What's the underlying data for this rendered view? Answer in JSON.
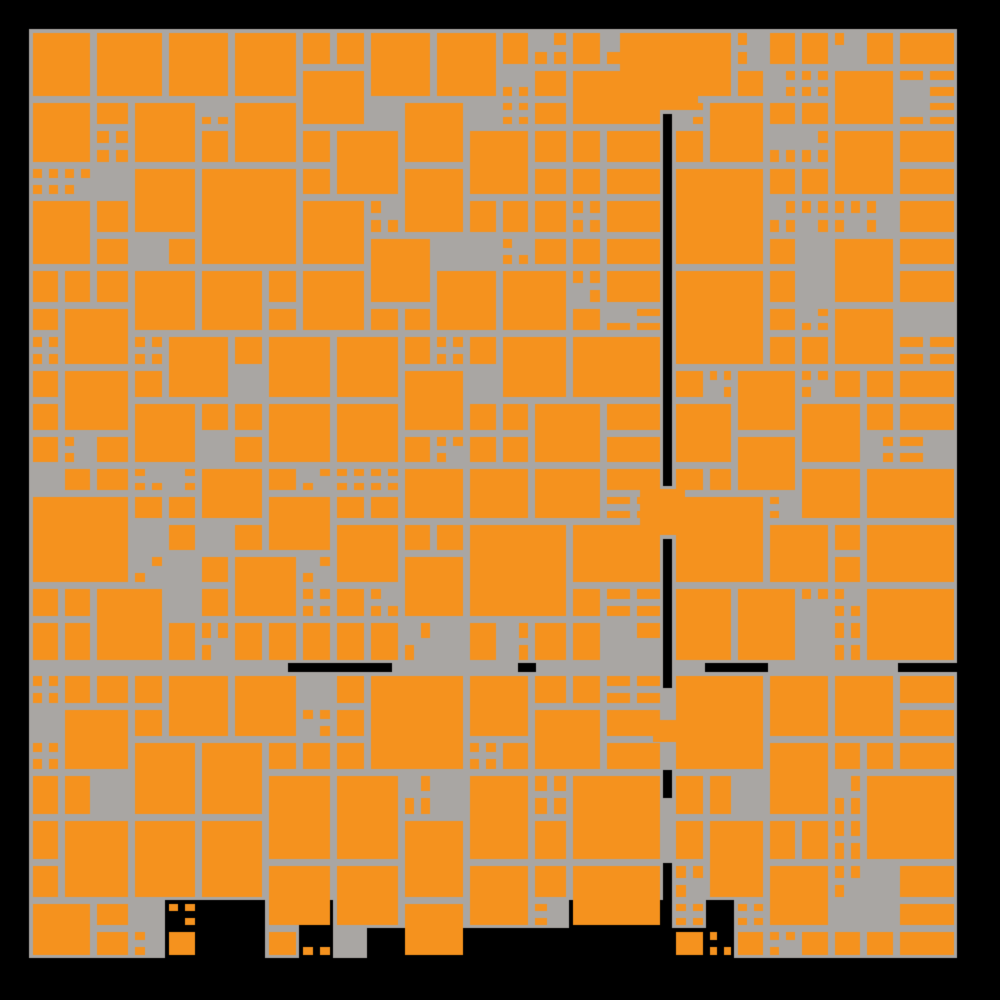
{
  "artwork": {
    "type": "generative-square-mosaic",
    "canvas": {
      "width": 1000,
      "height": 1000,
      "background": "#000000"
    },
    "palette": {
      "orange": "#f5921e",
      "gray": "#a9a6a3",
      "black": "#000000"
    },
    "region": {
      "left": 29,
      "top": 29,
      "right": 957,
      "row_end": 958,
      "v_gap": {
        "x": 663,
        "width": 9
      },
      "h_gap": {
        "y": 663,
        "height": 9
      },
      "gray_bottom_min": 878,
      "gray_bottom_max": 958
    },
    "grid": {
      "pitches": [
        28,
        32,
        33,
        34,
        38,
        45
      ],
      "grout": 7,
      "inset": 3.5
    },
    "generator": {
      "seed": 1337,
      "p_3x3": 0.055,
      "p_2x2": 0.34,
      "p_single_filled": 0.62,
      "p_single_split": 0.26,
      "p_half_filled": 0.75,
      "p_dangle": 0.28,
      "p_bottom_change": 0.5,
      "max_3x3_span": 108
    },
    "gap_black_segments": {
      "vertical": [
        {
          "x": 663,
          "y": 113,
          "width": 9,
          "height": 375
        },
        {
          "x": 663,
          "y": 535,
          "width": 9,
          "height": 153
        },
        {
          "x": 663,
          "y": 770,
          "width": 9,
          "height": 28
        },
        {
          "x": 663,
          "y": 863,
          "width": 9,
          "height": 65
        }
      ],
      "horizontal": [
        {
          "x": 288,
          "y": 663,
          "width": 104,
          "height": 9
        },
        {
          "x": 518,
          "y": 663,
          "width": 18,
          "height": 9
        },
        {
          "x": 705,
          "y": 663,
          "width": 63,
          "height": 9
        },
        {
          "x": 898,
          "y": 663,
          "width": 59,
          "height": 9
        }
      ]
    },
    "bridge_squares": [
      {
        "x": 620,
        "y": 33,
        "width": 78,
        "height": 77
      },
      {
        "x": 640,
        "y": 489,
        "width": 45,
        "height": 46
      },
      {
        "x": 653,
        "y": 720,
        "width": 47,
        "height": 22
      }
    ]
  }
}
